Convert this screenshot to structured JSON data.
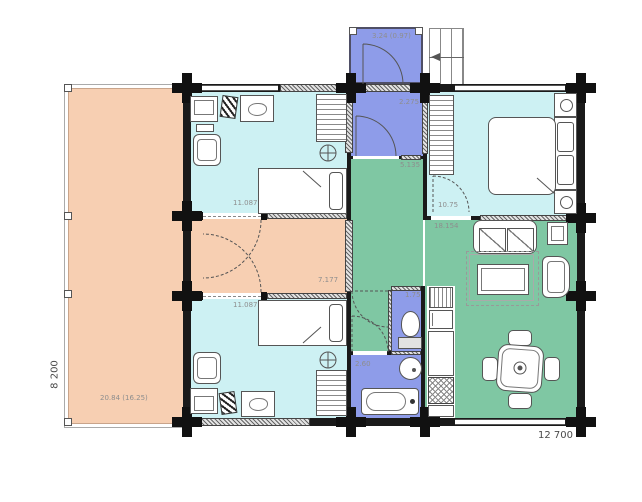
{
  "floorplan": {
    "dimensions": {
      "width": "12 700",
      "height": "8 200"
    },
    "areas": {
      "terrace": "20.84 (16.25)",
      "porch": "3.24 (0.97)",
      "entry_hall": "2.275",
      "corridor": "5.135",
      "bedroom_top": "11.087",
      "hall": "7.177",
      "bedroom_bottom": "11.087",
      "master_bedroom": "10.75",
      "living_room": "18.154",
      "wc": "1.75",
      "bathroom": "2.60"
    },
    "colors": {
      "terrace": "#f7cfb2",
      "bedroom": "#cdf1f3",
      "entry": "#8e9ce9",
      "living": "#7fc7a3",
      "wall": "#1a1a1a"
    }
  }
}
